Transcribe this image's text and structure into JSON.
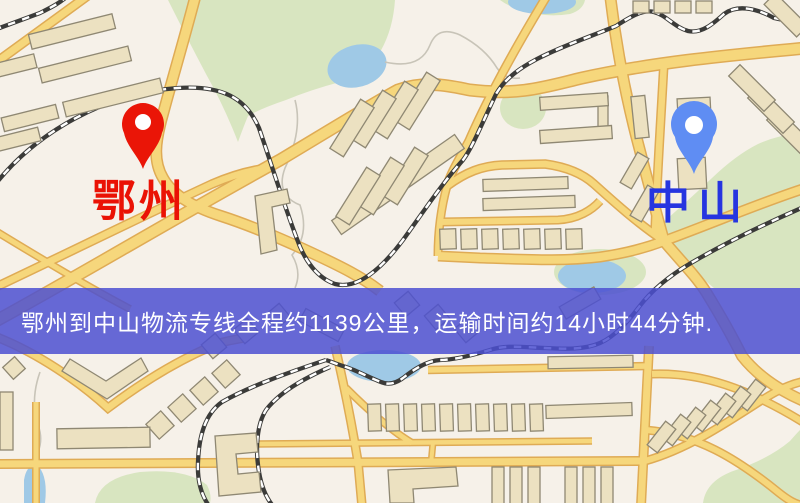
{
  "banner": {
    "text": "鄂州到中山物流专线全程约1139公里，运输时间约14小时44分钟.",
    "background_color": "#4c50d1",
    "text_color": "#ffffff"
  },
  "markers": {
    "origin": {
      "label": "鄂州",
      "label_color": "#ea1205",
      "pin_color": "#ea1507"
    },
    "destination": {
      "label": "中山",
      "label_color": "#2635e0",
      "pin_color": "#5f8df3"
    }
  },
  "route": {
    "origin": "鄂州",
    "destination": "中山",
    "distance_text": "全程约1139公里",
    "duration_text": "运输时间约14小时44分钟"
  },
  "map_colors": {
    "background": "#f6f1e9",
    "road_fill": "#f6d77c",
    "road_casing": "#dfab55",
    "park": "#d8e5c0",
    "water": "#9fc9e6",
    "building": "#ece1c1",
    "railway": "#3b3b39"
  }
}
